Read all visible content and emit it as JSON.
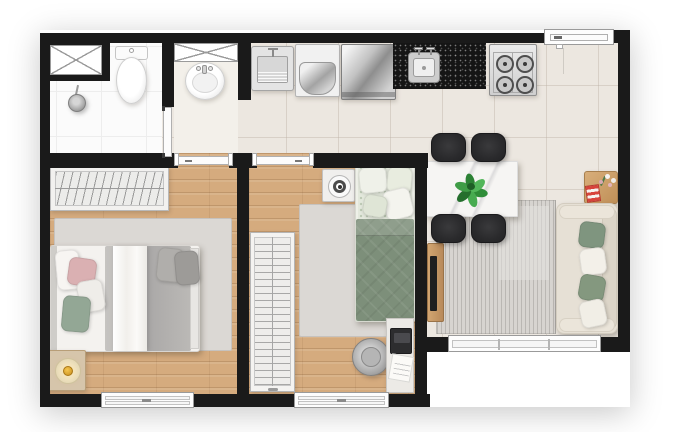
{
  "plan": {
    "type": "residential apartment floor plan",
    "view": "top-down 3D render, no text labels",
    "rooms": [
      {
        "name": "bathroom",
        "fixtures": [
          "ventilation shaft with X window",
          "shower head",
          "toilet",
          "swing door"
        ]
      },
      {
        "name": "hall lavatory nook",
        "fixtures": [
          "X vent window",
          "pedestal washbasin"
        ]
      },
      {
        "name": "kitchen and laundry line",
        "fixtures": [
          "laundry tank sink",
          "washing machine",
          "refrigerator",
          "black granite countertop",
          "stainless kitchen sink with two faucets",
          "four burner stove",
          "entry door"
        ]
      },
      {
        "name": "bedroom 1 double",
        "fixtures": [
          "wardrobe with hangers",
          "double bed with white, pink and green pillows",
          "gray blanket and white runner",
          "area rug",
          "nightstand",
          "gold table lamp",
          "window"
        ]
      },
      {
        "name": "bedroom 2 single",
        "fixtures": [
          "wardrobe with hangers",
          "single bed with green quilt and patterned pillows",
          "area rug",
          "nightstand",
          "round speaker",
          "desk",
          "laptop",
          "notebook",
          "desk chair",
          "window"
        ]
      },
      {
        "name": "living dining room",
        "fixtures": [
          "white marble dining table",
          "green plant centerpiece",
          "four black chairs",
          "striped gray rug",
          "wood TV sideboard",
          "TV",
          "cream sofa",
          "four green and white throw pillows",
          "wood side table",
          "flowers",
          "red striped decor box",
          "wide sliding window"
        ]
      }
    ],
    "doors": [
      "entry door top right",
      "bathroom door",
      "bedroom 1 door",
      "bedroom 2 door"
    ],
    "windows": [
      "bathroom shaft window",
      "hall vent window",
      "bedroom 1 window",
      "bedroom 2 window",
      "living room window"
    ]
  },
  "palette": {
    "wall": "#1a1a1a",
    "outside": "#ffffff",
    "tile_floor": "#ece7e0",
    "bathroom_floor": "#fbfbfb",
    "wood_floor": "#d5ab7e",
    "counter_granite": "#151515",
    "rug_gray": "#d8d5d1",
    "quilt_green": "#7d8f7a",
    "sofa_cream": "#e6e0d5",
    "pillow_green": "#7f957f",
    "pillow_pink": "#dab0b2",
    "chair_black": "#2e2e30",
    "plant_green": "#2f8d38",
    "furniture_wood": "#c79d6b",
    "lamp_gold": "#e3a93c"
  }
}
